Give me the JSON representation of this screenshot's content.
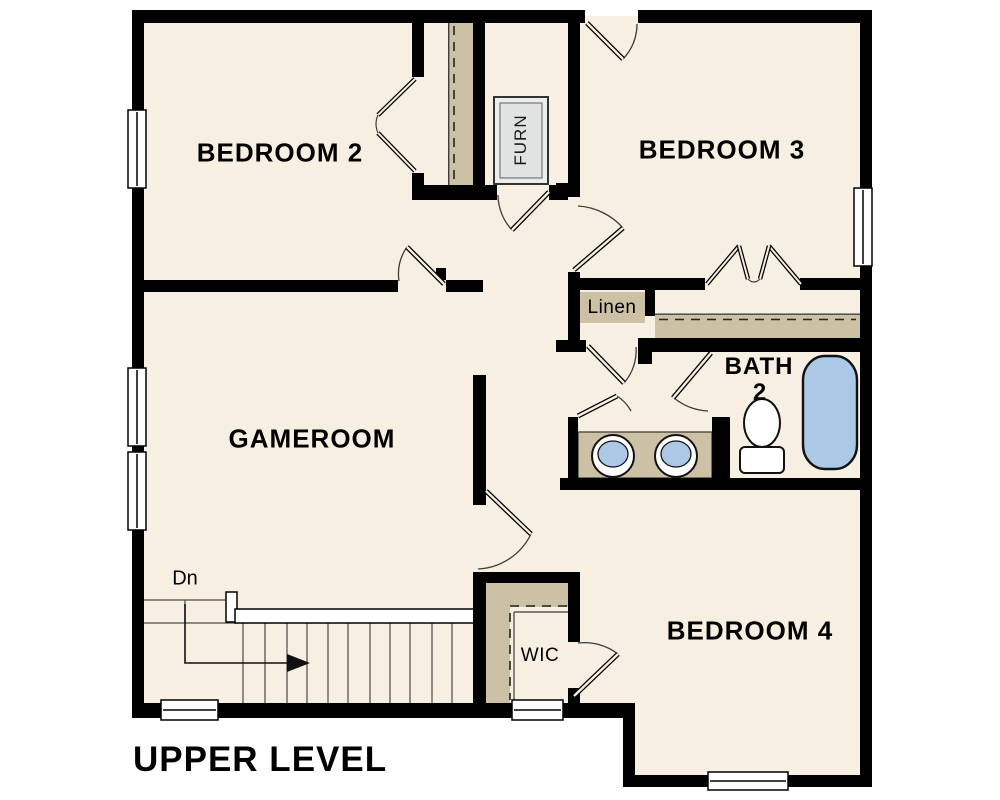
{
  "title": "UPPER LEVEL",
  "labels": {
    "bedroom2": "BEDROOM 2",
    "bedroom3": "BEDROOM 3",
    "bedroom4": "BEDROOM 4",
    "gameroom": "GAMEROOM",
    "bath_line1": "BATH",
    "bath_line2": "2",
    "linen": "Linen",
    "wic": "WIC",
    "furnace": "FURN",
    "stairs_down": "Dn"
  },
  "colors": {
    "wall": "#000000",
    "floor": "#f7efe2",
    "closet_shelf": "#cdc1a5",
    "fixture_blue": "#abc9e6",
    "furnace_gray": "#dfe3e1",
    "detail_line": "#3c3c3c"
  }
}
